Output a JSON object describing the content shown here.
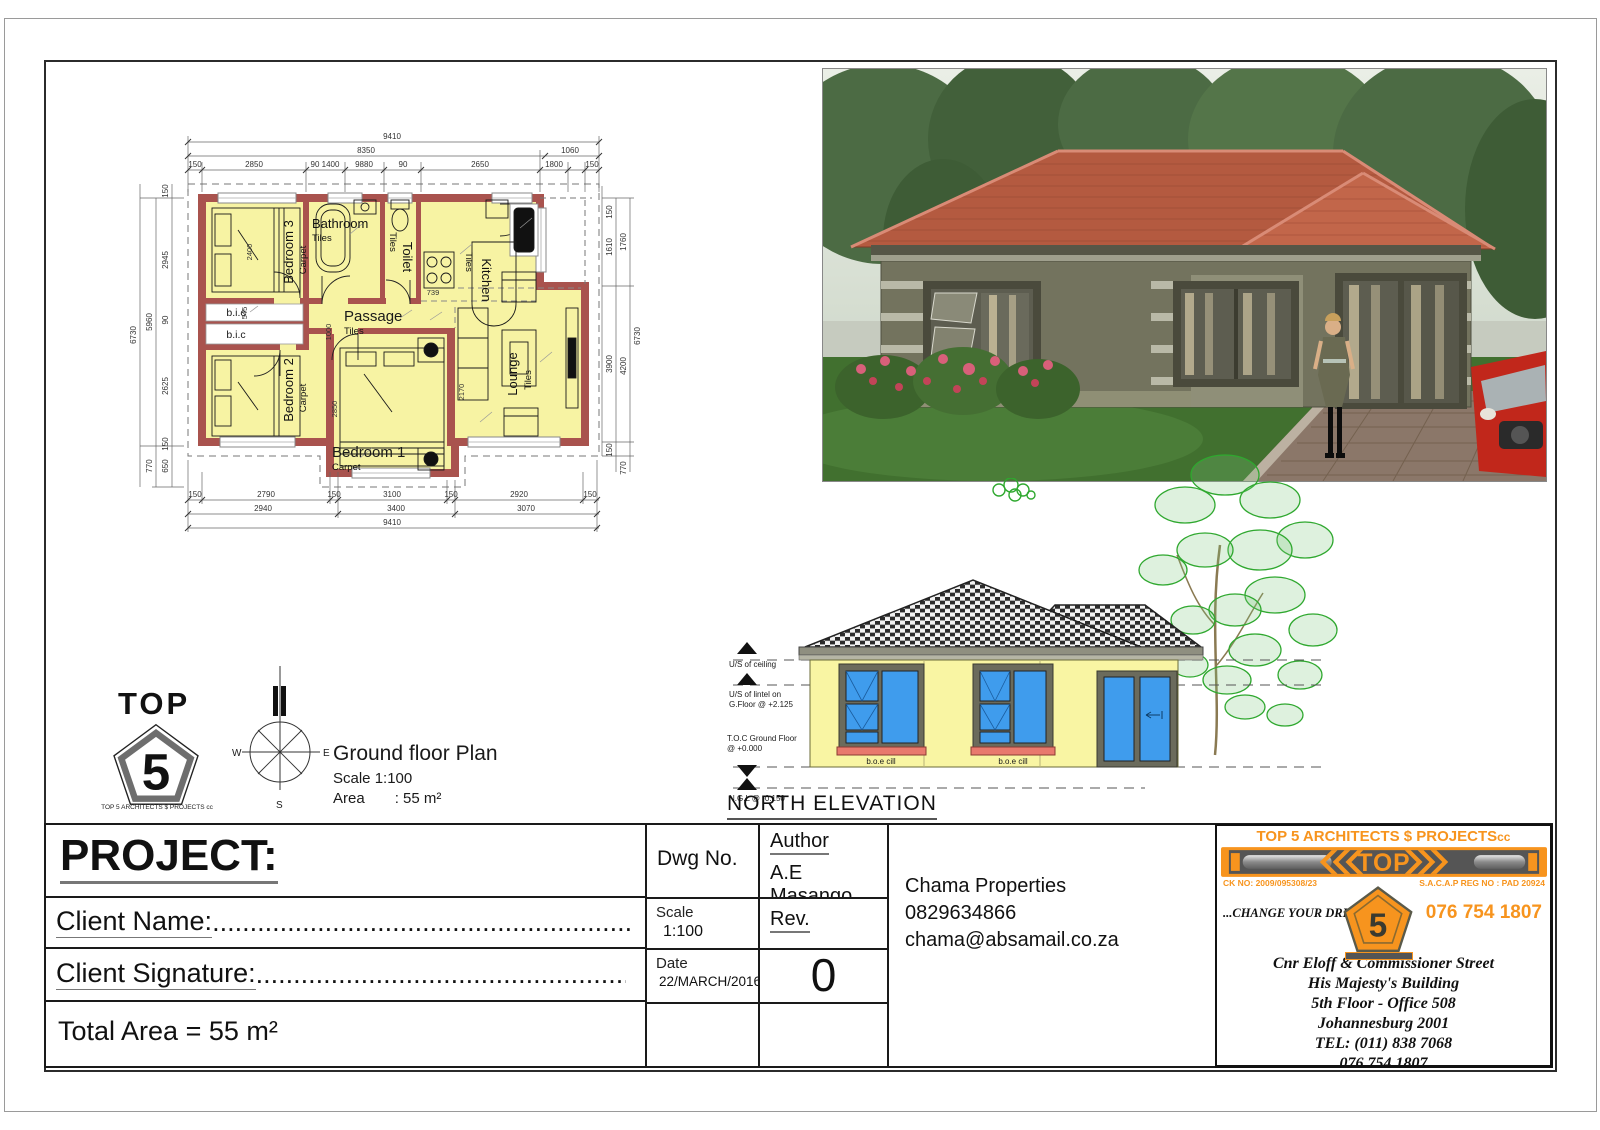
{
  "plan": {
    "caption": {
      "title": "Ground floor Plan",
      "scale": "Scale 1:100",
      "area_label": "Area",
      "area_value": ": 55 m²"
    },
    "rooms": {
      "bedroom3": {
        "name": "Bedroom 3",
        "floor": "Carpet"
      },
      "bathroom": {
        "name": "Bathroom",
        "floor": "Tiles"
      },
      "toilet": {
        "name": "Toilet",
        "floor": "Tiles"
      },
      "kitchen": {
        "name": "Kitchen",
        "floor": "Tiles"
      },
      "passage": {
        "name": "Passage",
        "floor": "Tiles"
      },
      "bedroom2": {
        "name": "Bedroom 2",
        "floor": "Carpet"
      },
      "bedroom1": {
        "name": "Bedroom 1",
        "floor": "Carpet"
      },
      "lounge": {
        "name": "Lounge",
        "floor": "Tiles"
      },
      "bic_top": "b.i.c",
      "bic_bottom": "b.i.c"
    },
    "dims": {
      "top1": "9410",
      "top2": [
        "8350",
        "1060"
      ],
      "top3": [
        "150",
        "2850",
        "90 1400",
        "9880",
        "90",
        "2650",
        "1800",
        "150"
      ],
      "bottom1": [
        "150",
        "2790",
        "150",
        "3100",
        "150",
        "2920",
        "150"
      ],
      "bottom2": [
        "2940",
        "3400",
        "3070"
      ],
      "bottom3": "9410",
      "left1": [
        "150",
        "2945",
        "90",
        "2625",
        "150",
        "650"
      ],
      "left2": [
        "5960",
        "770"
      ],
      "left3": "6730",
      "right1": [
        "150",
        "1610",
        "3900",
        "150"
      ],
      "right2": [
        "1760",
        "4200",
        "770"
      ],
      "right3": "6730",
      "interior": {
        "bed3": "2400",
        "bic": "545",
        "passage": "1000",
        "bed1": "2850",
        "lounge": "2170",
        "kitchen": "739"
      }
    }
  },
  "compass": {
    "west": "W",
    "east": "E",
    "south": "S"
  },
  "logo_left": {
    "word": "TOP",
    "number": "5",
    "subtext": "TOP 5 ARCHITECTS $ PROJECTS cc"
  },
  "elevation": {
    "title": "NORTH ELEVATION",
    "levels": {
      "ceiling": "U/S of ceiling",
      "lintel_line1": "U/S of lintel on",
      "lintel_line2": "G.Floor @ +2.125",
      "toc_line1": "T.O.C Ground Floor",
      "toc_line2": "@ +0.000",
      "ngl": "N.G.L @ -0.150"
    },
    "cill_left": "b.o.e cill",
    "cill_right": "b.o.e cill"
  },
  "titleblock": {
    "project_label": "PROJECT:",
    "client_name_label": "Client Name:",
    "client_name_dots": "......................................................................................................",
    "client_signature_label": "Client Signature:",
    "client_signature_dots": "......................................................................................................",
    "total_area": "Total Area = 55 m²",
    "dwg_label": "Dwg No.",
    "author_label": "Author",
    "author_value": "A.E Masango",
    "scale_label": "Scale",
    "scale_value": "1:100",
    "rev_label": "Rev.",
    "rev_value": "0",
    "date_label": "Date",
    "date_value": "22/MARCH/2016",
    "company": "Chama Properties",
    "phone": "0829634866",
    "email": "chama@absamail.co.za"
  },
  "brand": {
    "header": "TOP 5 ARCHITECTS $ PROJECTS",
    "header_suffix": "cc",
    "banner_word": "TOP",
    "ck_no": "CK NO: 2009/095308/23",
    "sacap": "S.A.C.A.P REG NO : PAD 20924",
    "slogan": "...CHANGE YOUR DREAM...",
    "phone": "076 754 1807",
    "pent_number": "5",
    "address": [
      "Cnr Eloff & Commissioner Street",
      "His  Majesty's Building",
      "5th Floor - Office 508",
      "Johannesburg 2001",
      "TEL: (011) 838 7068",
      "076 754 1807"
    ]
  },
  "colors": {
    "accent": "#F7941E",
    "plan_wall": "#A9534E",
    "plan_room": "#F7F3A3",
    "elev_wall": "#F9F5A3",
    "glass": "#3F9CED",
    "cill": "#E8796D",
    "roof": "#BE5B41"
  }
}
